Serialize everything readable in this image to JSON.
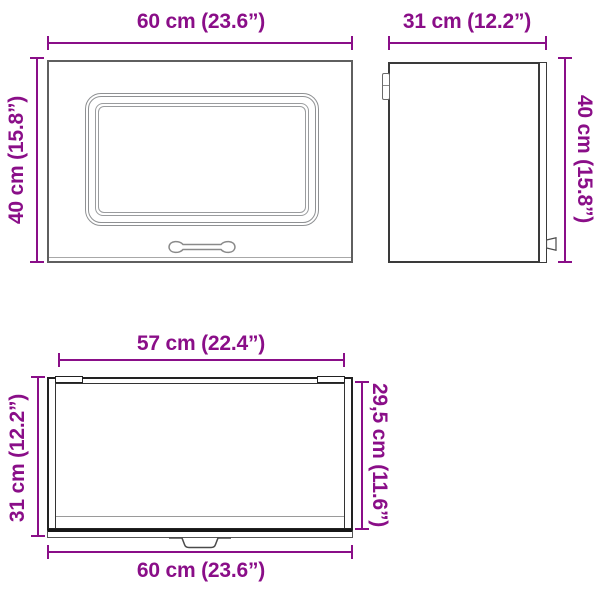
{
  "diagram": {
    "title": "wall-cabinet-dimension-diagram",
    "accent_color": "#8a0e88",
    "front_view": {
      "width_label": "60 cm (23.6”)",
      "height_label": "40 cm (15.8”)"
    },
    "side_view": {
      "width_label": "31 cm (12.2”)",
      "height_label": "40 cm (15.8”)"
    },
    "top_view": {
      "inner_width_label": "57 cm (22.4”)",
      "depth_label": "31 cm (12.2”)",
      "inner_depth_label": "29,5 cm (11.6”)",
      "outer_width_label": "60 cm (23.6”)"
    }
  }
}
